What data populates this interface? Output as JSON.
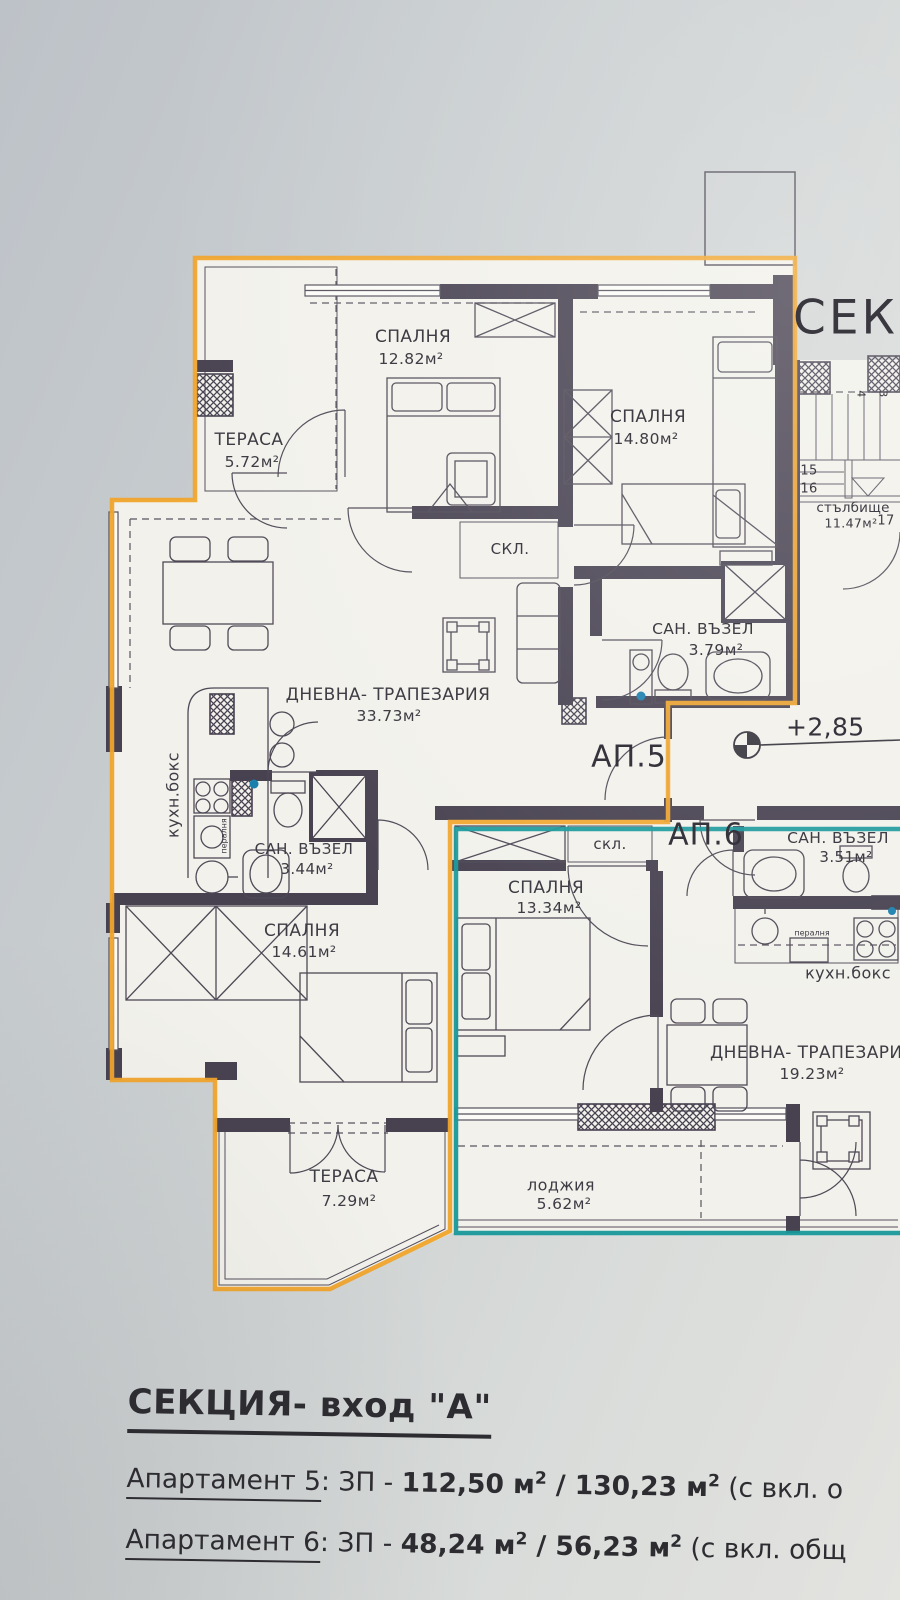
{
  "plan": {
    "section_heading_partial": "СЕКЦ",
    "elevation": "+2,85",
    "colors": {
      "ap5_outline": "#f0a42c",
      "ap6_outline": "#18989b",
      "walls": "#474150"
    },
    "apartments": {
      "ap5": {
        "label": "АП.5",
        "rooms": {
          "terrace_top": {
            "name": "ТЕРАСА",
            "area": "5.72м²"
          },
          "bedroom_top": {
            "name": "СПАЛНЯ",
            "area": "12.82м²"
          },
          "bedroom_right": {
            "name": "СПАЛНЯ",
            "area": "14.80м²"
          },
          "storage": {
            "name": "СКЛ."
          },
          "bath": {
            "name": "САН. ВЪЗЕЛ",
            "area": "3.79м²"
          },
          "living": {
            "name": "ДНЕВНА- ТРАПЕЗАРИЯ",
            "area": "33.73м²"
          },
          "kitchen": {
            "name": "кухн.бокс"
          },
          "laundry": {
            "name": "пералня"
          },
          "bath2": {
            "name": "САН. ВЪЗЕЛ",
            "area": "3.44м²"
          },
          "bedroom_bottom": {
            "name": "СПАЛНЯ",
            "area": "14.61м²"
          },
          "terrace_bottom": {
            "name": "ТЕРАСА",
            "area": "7.29м²"
          }
        }
      },
      "ap6": {
        "label": "АП.6",
        "rooms": {
          "storage": {
            "name": "скл."
          },
          "bath": {
            "name": "САН. ВЪЗЕЛ",
            "area": "3.51м²"
          },
          "bedroom": {
            "name": "СПАЛНЯ",
            "area": "13.34м²"
          },
          "kitchen": {
            "name": "кухн.бокс"
          },
          "laundry": {
            "name": "пералня"
          },
          "living": {
            "name": "ДНЕВНА- ТРАПЕЗАРИЯ",
            "area": "19.23м²"
          },
          "loggia": {
            "name": "лоджия",
            "area": "5.62м²"
          }
        }
      }
    },
    "stairwell": {
      "name": "стълбище",
      "area": "11.47м²",
      "steps": [
        "15",
        "16",
        "17",
        "4",
        "3"
      ]
    }
  },
  "legend": {
    "title": "СЕКЦИЯ- вход \"А\"",
    "sup": "2",
    "items": [
      {
        "label": "Апартамент 5",
        "sep": ": ЗП - ",
        "v1": "112,50 м",
        "slash": " / ",
        "v2": "130,23 м",
        "tail": " (с вкл. о"
      },
      {
        "label": "Апартамент 6",
        "sep": ": ЗП - ",
        "v1": "48,24 м",
        "slash": " / ",
        "v2": "56,23 м",
        "tail": " (с вкл. общ"
      }
    ]
  }
}
